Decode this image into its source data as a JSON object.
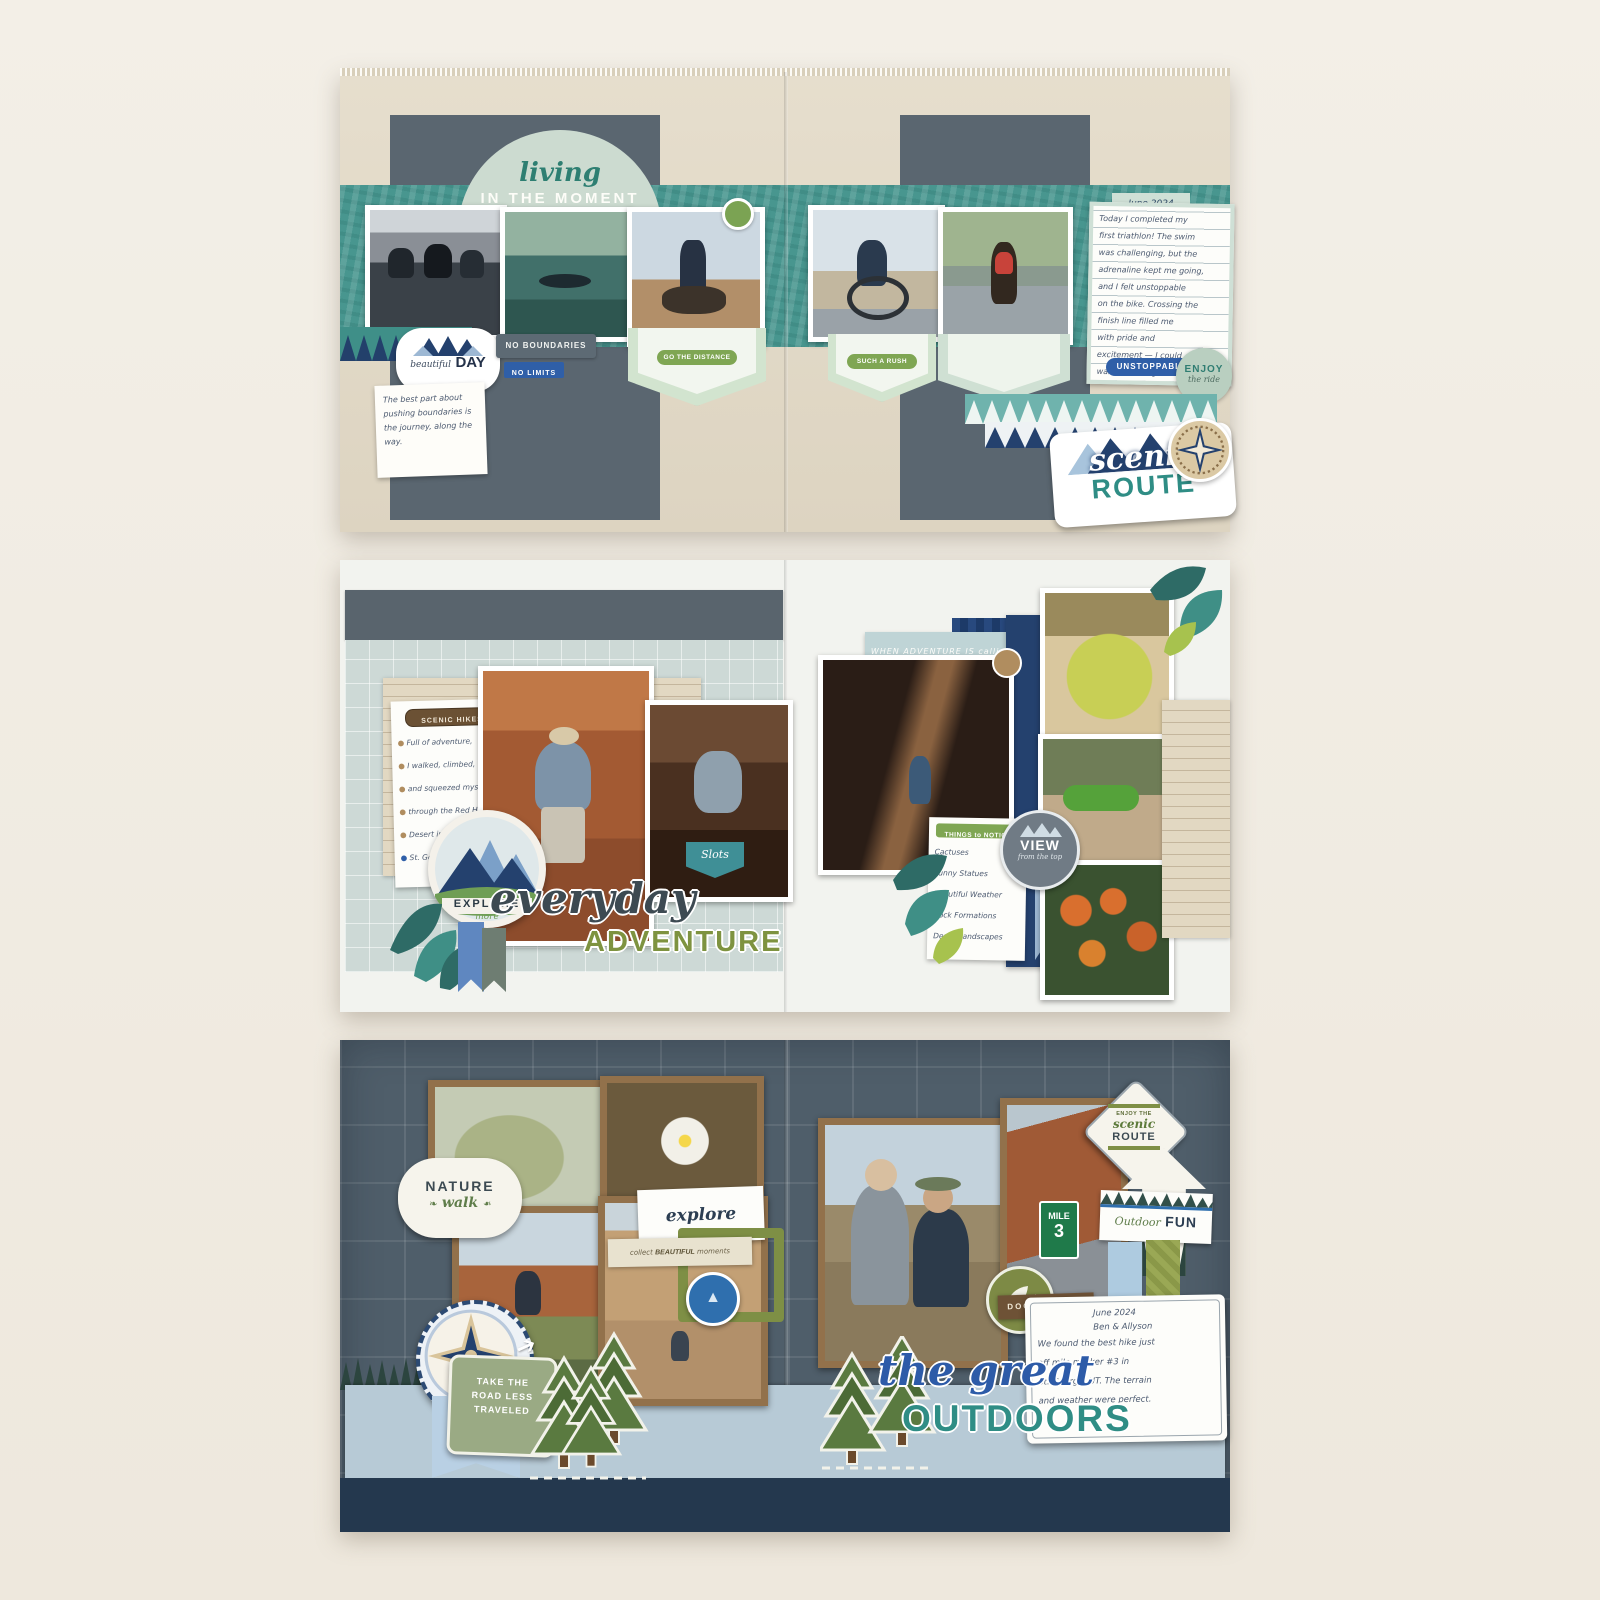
{
  "colors": {
    "cream_bg": "#f1ece3",
    "tan_paper": "#e0d8c6",
    "slate": "#5a6670",
    "teal_band": "#48968f",
    "sage": "#ccdbd0",
    "navy": "#23406b",
    "blue": "#2f5fa8",
    "olive": "#7e9340",
    "leaf_green": "#7fa653",
    "kraft": "#92714b",
    "chalkboard": "#4f5e6a",
    "light_blue_band": "#b7cad6",
    "teal_accent": "#2f8d85"
  },
  "spread1": {
    "title_script": "living",
    "title_caps": "IN THE MOMENT",
    "day_script": "beautiful",
    "day_caps": "DAY",
    "tag_no_boundaries": "NO BOUNDARIES",
    "tag_no_limits": "NO LIMITS",
    "pill_left": "GO THE DISTANCE",
    "pill_right": "SUCH A RUSH",
    "note_text": "The best part about pushing boundaries is the journey, along the way.",
    "journal_date": "June 2024",
    "journal_lines": [
      "Today I completed my",
      "first triathlon! The swim",
      "was challenging, but the",
      "adrenaline kept me going,",
      "and I felt unstoppable",
      "on the bike. Crossing the",
      "finish line filled me",
      "with pride and",
      "excitement — I could",
      "wait to do it again!"
    ],
    "tag_unstoppable": "UNSTOPPABLE",
    "enjoy_caps": "ENJOY",
    "enjoy_script": "the ride",
    "scenic_script": "scenic",
    "scenic_caps": "ROUTE"
  },
  "spread2": {
    "list_header": "SCENIC HIKES",
    "list_lines": [
      "Full of adventure,",
      "I walked, climbed,",
      "and squeezed myself",
      "through the Red Hills",
      "Desert in",
      "St. George."
    ],
    "badge_explore": "EXPLORE",
    "badge_explore_script": "more",
    "tag_slots": "Slots",
    "banner_text": "WHEN ADVENTURE IS calling YOU MUST GO",
    "title_script": "everyday",
    "title_caps": "ADVENTURE",
    "notice_header": "THINGS to NOTICE",
    "notice_lines": [
      "Cactuses",
      "Funny Statues",
      "Beautiful Weather",
      "Rock Formations",
      "Desert landscapes"
    ],
    "view_caps": "VIEW",
    "view_script": "from the top"
  },
  "spread3": {
    "nature_caps": "NATURE",
    "nature_script": "walk",
    "tag_explore": "explore",
    "collect_pre": "collect",
    "collect_bold": "BEAUTIFUL",
    "collect_post": "moments",
    "sign_top": "ENJOY THE",
    "sign_script": "scenic",
    "sign_caps": "ROUTE",
    "outdoor_script": "Outdoor",
    "outdoor_caps": "FUN",
    "mile_word": "MILE",
    "mile_num": "3",
    "road_tag_lines": [
      "TAKE THE",
      "ROAD LESS",
      "TRAVELED"
    ],
    "tag_documented": "DOCUMENTED",
    "journal_lines": [
      "June 2024",
      "Ben & Allyson",
      "We found the best hike just",
      "off mile marker #3 in",
      "St. George, UT. The terrain",
      "and weather were perfect."
    ],
    "title_script": "the great",
    "title_caps": "OUTDOORS"
  }
}
